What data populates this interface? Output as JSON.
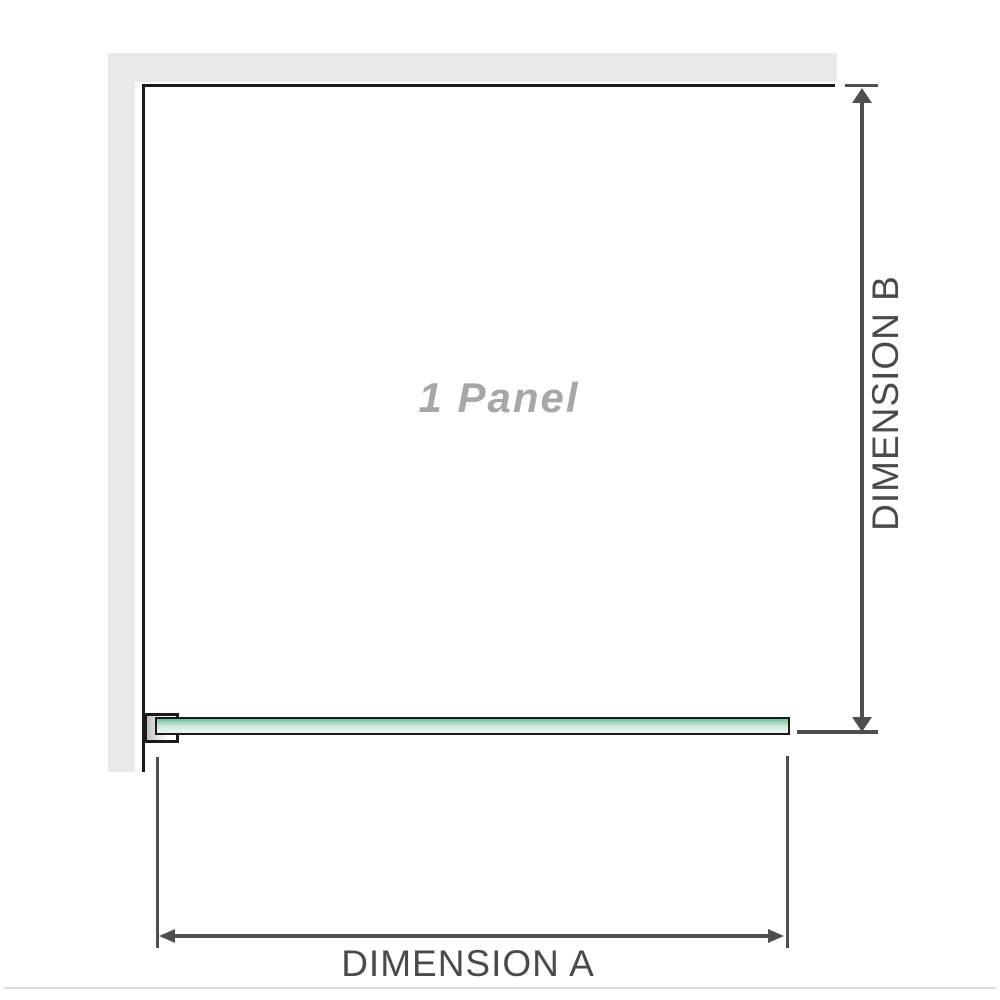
{
  "diagram": {
    "panel_label": "1 Panel",
    "dimension_a": {
      "label": "DIMENSION A"
    },
    "dimension_b": {
      "label": "DIMENSION B"
    }
  },
  "colors": {
    "wall_gray": "#e9e9e9",
    "outline_black": "#1a1a1a",
    "dimension_gray": "#4f4f4f",
    "text_dark": "#4a4a4a",
    "label_gray": "#a7a7a7",
    "glass_green_dark": "#74bd9a",
    "glass_green_mid": "#c9e9da",
    "glass_green_light": "#eef8f3",
    "bracket_shadow": "#bdbdbd",
    "baseline_gray": "#dedede"
  }
}
